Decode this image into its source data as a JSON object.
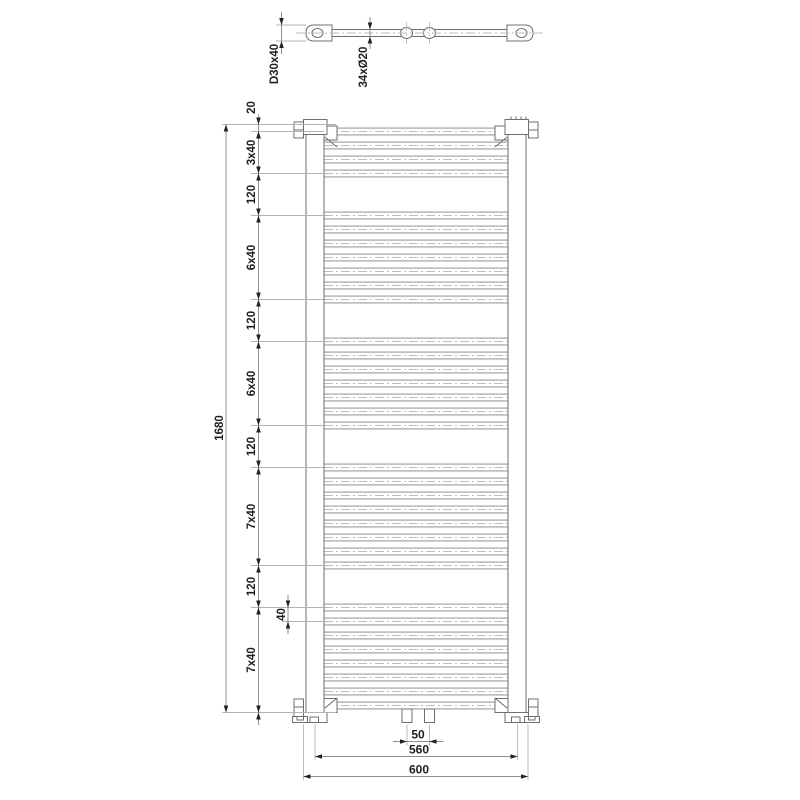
{
  "drawing": {
    "type": "technical-dimension-drawing",
    "subject": "heated towel rail radiator - front view and top view with dimension chains",
    "top_view": {
      "bracket_profile_label": "D30x40",
      "tube_spec_label": "34xØ20",
      "connection_count": 2,
      "wall_bracket_count": 2
    },
    "front_view": {
      "tube_groups": [
        {
          "tubes": 4,
          "pitch_label": "3x40"
        },
        {
          "tubes": 7,
          "pitch_label": "6x40"
        },
        {
          "tubes": 7,
          "pitch_label": "6x40"
        },
        {
          "tubes": 8,
          "pitch_label": "7x40"
        },
        {
          "tubes": 8,
          "pitch_label": "7x40"
        }
      ],
      "total_tubes": 34,
      "group_gap_label": "120",
      "end_margin_label": "20",
      "connection_stub_count": 2
    },
    "dimensions": {
      "left_chain": [
        "20",
        "3x40",
        "120",
        "6x40",
        "120",
        "6x40",
        "120",
        "7x40",
        "120",
        "7x40",
        "20"
      ],
      "overall_height": "1680",
      "tube_pitch_detail": "40",
      "connection_spacing": "50",
      "collector_spacing": "560",
      "overall_width": "600"
    },
    "colors": {
      "background": "#ffffff",
      "geometry_line": "#6f6f6f",
      "tube_line": "#818181",
      "centerline": "#bcbcbc",
      "extension_line": "#b3b3b3",
      "dimension_line": "#8f8f8f",
      "arrow": "#222222",
      "text": "#1f1f1f"
    }
  }
}
